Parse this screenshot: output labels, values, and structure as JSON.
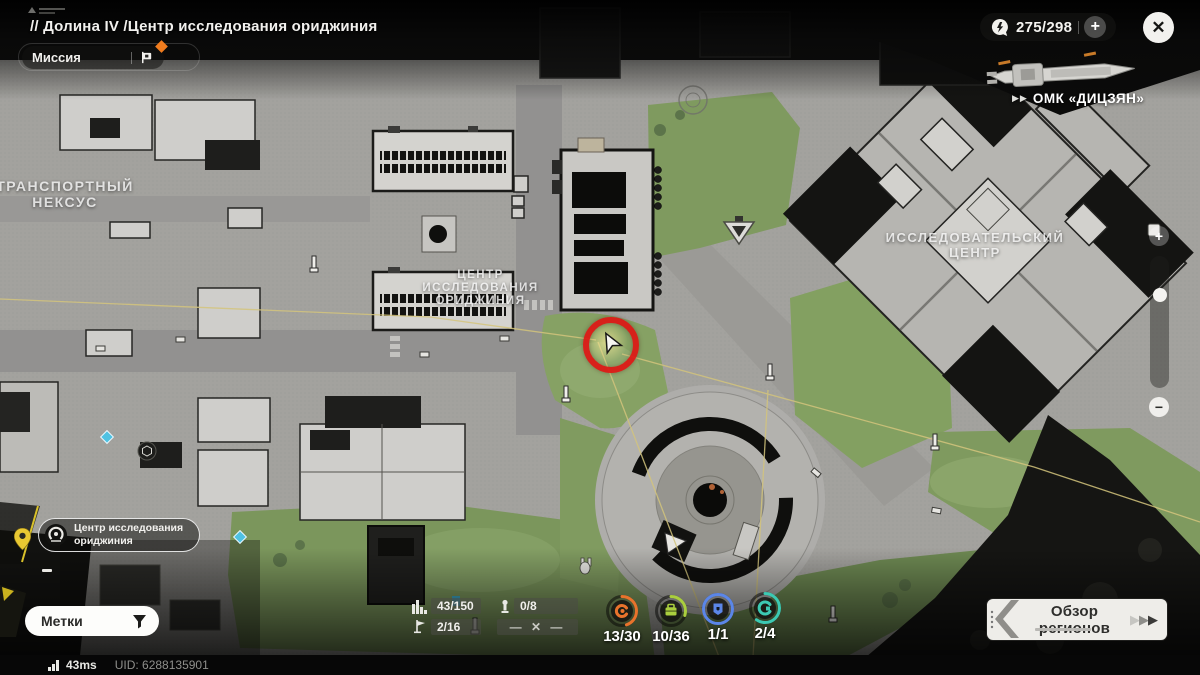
{
  "header": {
    "breadcrumb": "// Долина IV  /Центр исследования ориджиния",
    "mission": "Миссия",
    "energy": "275/298",
    "plus": "+",
    "close": "✕"
  },
  "ship": {
    "arrows": "▶▶",
    "name": "ОМК «ДИЦЗЯН»"
  },
  "zoom_control": {
    "in": "+",
    "out": "−"
  },
  "map_labels": {
    "transport": [
      "ТРАНСПОРТНЫЙ",
      "НЕКСУС"
    ],
    "originium_center": [
      "ЦЕНТР",
      "ИССЛЕДОВАНИЯ",
      "ОРИДЖИНИЯ"
    ],
    "research_center": [
      "ИССЛЕДОВАТЕЛЬСКИЙ",
      "ЦЕНТР"
    ]
  },
  "objective": {
    "title": "Центр исследования ориджиния"
  },
  "markers": {
    "label": "Метки"
  },
  "stats": {
    "bars": "43/150",
    "totem": "0/8",
    "flag": "2/16",
    "locked": "— ✕ —"
  },
  "collectibles": [
    {
      "value": "13/30",
      "color": "#e8732c",
      "progress": 0.45
    },
    {
      "value": "10/36",
      "color": "#aacf3e",
      "progress": 0.3
    },
    {
      "value": "1/1",
      "color": "#5b86e8",
      "progress": 1
    },
    {
      "value": "2/4",
      "color": "#3cc9b2",
      "progress": 0.6
    }
  ],
  "region_overview": {
    "label": "Обзор регионов",
    "arrows": [
      "▶",
      "▶",
      "▶"
    ]
  },
  "status_bar": {
    "ping": "43ms",
    "uid": "UID: 6288135901"
  },
  "colors": {
    "accent_orange": "#f07c1e",
    "marker_red": "#de1614",
    "pin_yellow": "#e9c832",
    "path_yellow": "#d3c47c",
    "teleport_cyan": "#4fc2e2"
  }
}
